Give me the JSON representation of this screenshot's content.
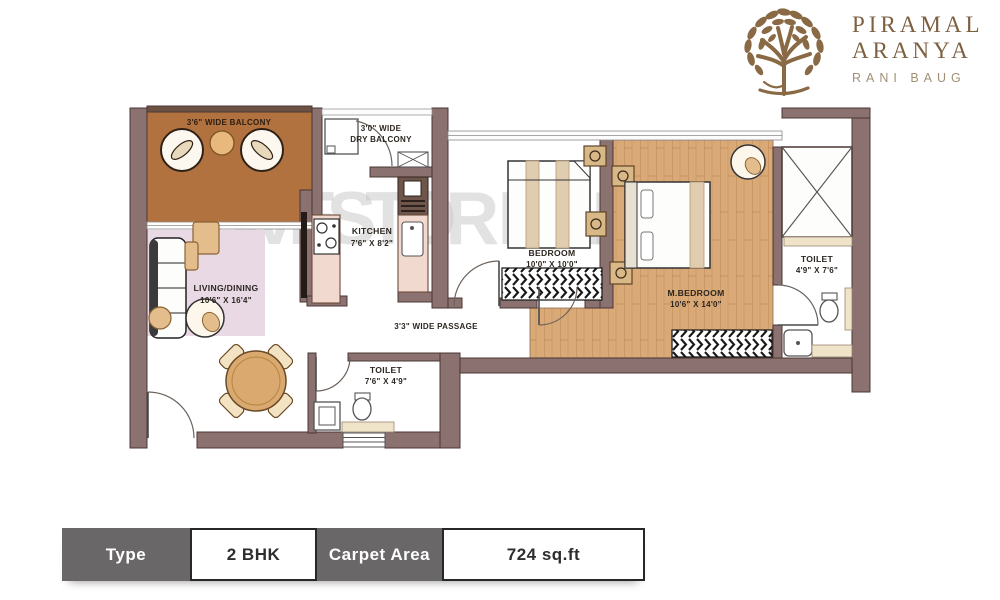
{
  "brand": {
    "name_line1": "PIRAMAL",
    "name_line2": "ARANYA",
    "tagline": "RANI BAUG"
  },
  "watermark": "INVESTOR MART",
  "plan": {
    "balcony": {
      "label": "3'6\" WIDE BALCONY"
    },
    "dry_balcony": {
      "line1": "3'0\" WIDE",
      "line2": "DRY BALCONY"
    },
    "kitchen": {
      "name": "KITCHEN",
      "dims": "7'6\" X 8'2\""
    },
    "living_dining": {
      "name": "LIVING/DINING",
      "dims": "10'6\" X 16'4\""
    },
    "passage": {
      "label": "3'3\" WIDE PASSAGE"
    },
    "common_toilet": {
      "name": "TOILET",
      "dims": "7'6\" X 4'9\""
    },
    "bedroom": {
      "name": "BEDROOM",
      "dims": "10'0\" X 10'0\""
    },
    "master_bedroom": {
      "name": "M.BEDROOM",
      "dims": "10'6\" X 14'0\""
    },
    "master_toilet": {
      "name": "TOILET",
      "dims": "4'9\" X 7'6\""
    }
  },
  "summary": {
    "columns": [
      {
        "label": "Type",
        "value": "2 BHK"
      },
      {
        "label": "Carpet Area",
        "value": "724 sq.ft"
      }
    ]
  },
  "colors": {
    "wall": "#8b7170",
    "balcony_floor": "#b2723f",
    "carpet": "#e9d9e5",
    "kitchen_counter": "#f2d9cf",
    "wood_floor": "#d9a977",
    "furniture_tan": "#e3bd8c",
    "table_header_bg": "#6a6768",
    "brand_bronze": "#7d6040",
    "brand_tagline": "#a29076",
    "watermark_gray": "#c6c6c6"
  }
}
